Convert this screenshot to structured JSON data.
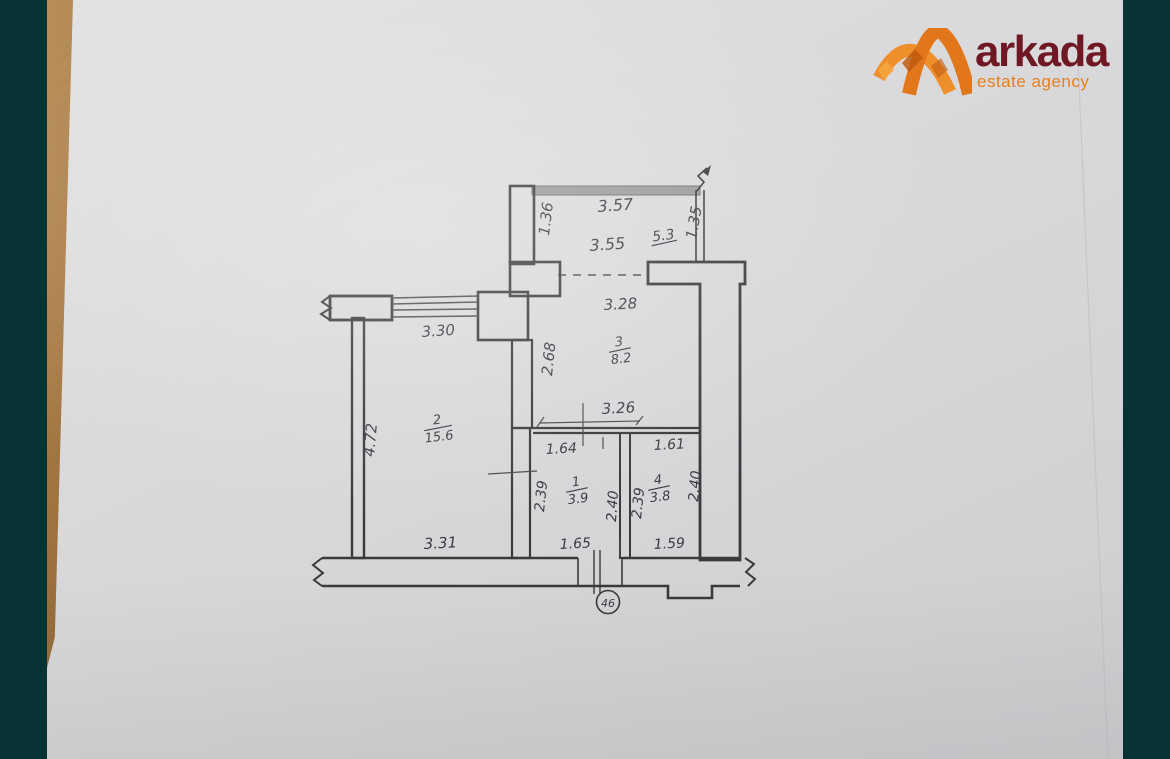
{
  "branding": {
    "logo_text": "arkada",
    "tagline": "estate agency",
    "brand_maroon": "#6f1823",
    "brand_orange": "#e87e1e"
  },
  "colors": {
    "background_teal": "#083335",
    "paper_gray": "#d8d8da",
    "wood_edge": "#a97c46",
    "ink": "#3a3a3d",
    "railing_gray": "#9a9a9c"
  },
  "floorplan": {
    "unit_number": "46",
    "rooms": [
      {
        "number": "1",
        "area": "3.9"
      },
      {
        "number": "2",
        "area": "15.6"
      },
      {
        "number": "3",
        "area": "8.2"
      },
      {
        "number": "4",
        "area": "3.8"
      }
    ],
    "dims": {
      "balcony": {
        "top": "3.57",
        "left": "1.36",
        "right": "1.35",
        "inner_width": "3.55",
        "area": "5.3"
      },
      "kitchen": {
        "top": "3.28",
        "left": "2.68",
        "bottom": "3.26"
      },
      "living": {
        "top": "3.30",
        "left": "4.72",
        "bottom": "3.31"
      },
      "hall": {
        "top": "1.64",
        "left": "2.39",
        "right": "2.40",
        "bottom": "1.65"
      },
      "bath": {
        "top": "1.61",
        "left": "2.39",
        "right": "2.40",
        "bottom": "1.59"
      }
    }
  }
}
